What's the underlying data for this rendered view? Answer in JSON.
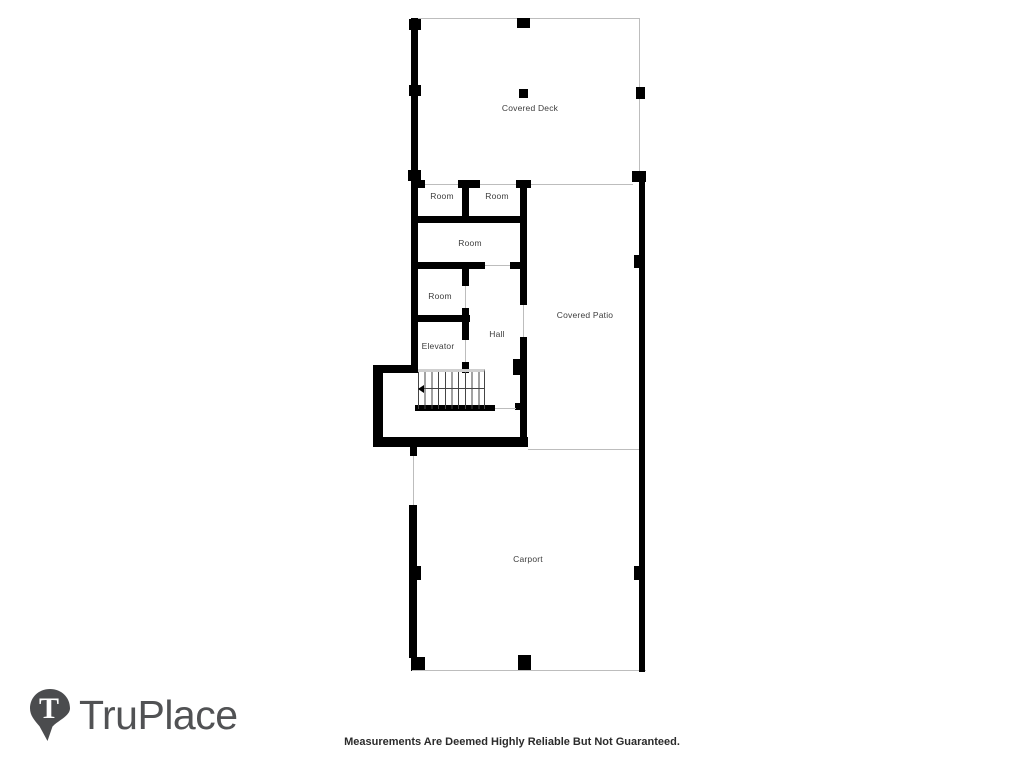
{
  "plan": {
    "labels": {
      "covered_deck": "Covered Deck",
      "room_top_left": "Room",
      "room_top_right": "Room",
      "room_middle": "Room",
      "room_lower": "Room",
      "elevator": "Elevator",
      "hall": "Hall",
      "covered_patio": "Covered Patio",
      "carport": "Carport"
    },
    "colors": {
      "wall": "#000000",
      "thin_line": "#bdbdbd",
      "label_text": "#3d3d3d"
    }
  },
  "branding": {
    "logo_text": "TruPlace",
    "logo_monogram": "T",
    "logo_color": "#515254"
  },
  "footer": {
    "disclaimer": "Measurements Are Deemed Highly Reliable But Not Guaranteed."
  }
}
